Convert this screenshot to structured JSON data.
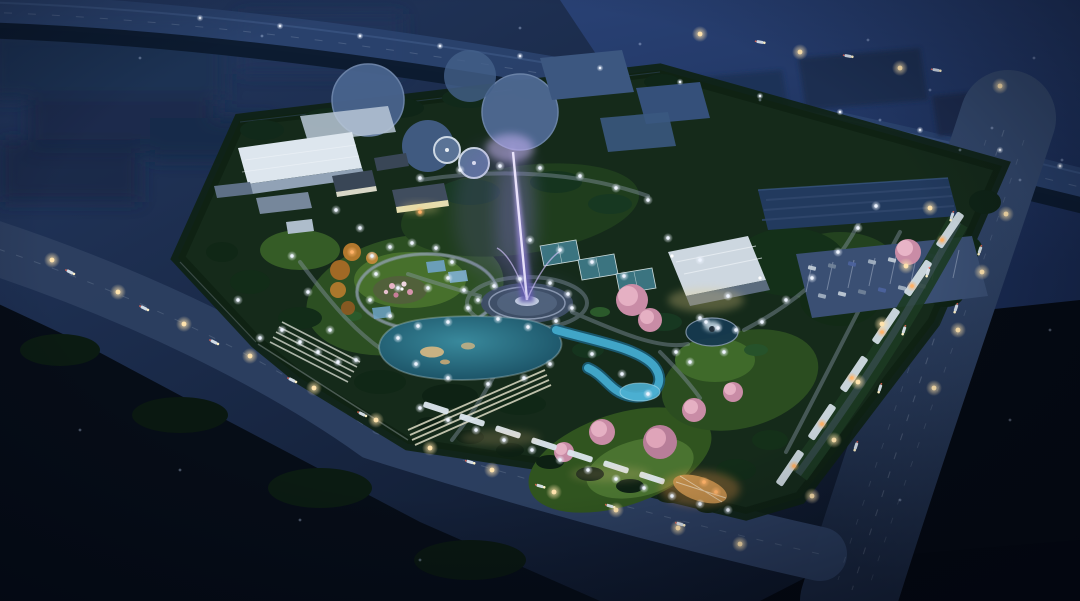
{
  "scene": {
    "type": "architectural-night-rendering",
    "subject": "Aerial night view of a landscaped park built over a water-treatment campus, surrounded by city roads",
    "time_of_day": "night",
    "features": [
      "central-plaza-with-purple-illuminated-fountain",
      "turquoise-lagoon-pond-with-islands",
      "winding-blue-stream",
      "circular-pond-with-fountain-sculpture",
      "circular-flower-garden-with-ring-path",
      "sports-courts",
      "greenhouse-gabled-building",
      "white-warehouse-buildings",
      "heritage-style-houses",
      "water-treatment-circular-tanks",
      "office-block-and-parking-lot",
      "lit-promenade-canopies-and-terraced-steps",
      "east-boulevard-with-pergolas-and-cherry-blossoms",
      "perimeter-roads-with-street-lights-and-cars",
      "highway-at-top",
      "scattered-path-lights",
      "dark-tree-masses",
      "pink-blossom-trees",
      "autumn-orange-trees",
      "hazy-city-blocks-in-distance"
    ]
  },
  "palette": {
    "bg_top": "#243962",
    "bg_bottom": "#0a1220",
    "city_haze": "#1d2f51",
    "ne_expanse_top": "#2a4378",
    "ne_expanse_bottom": "#1a2c55",
    "highway": "#2c4470",
    "treeline": "#0c1a2e",
    "forest_dark": "#060d17",
    "road": "#2c3f60",
    "road_right_top": "#33486c",
    "road_right_bottom": "#1b2942",
    "lane_mark": "#cdd9e8",
    "site_green": "#152a1a",
    "lawn": "#2c4f22",
    "lawn_lit": "#47702c",
    "pond_light": "#39899c",
    "pond_deep": "#134357",
    "stream": "#43aacb",
    "plaza": "#394a5b",
    "plaza_ring": "#9fadbf",
    "fountain_light": "#cfc0f4",
    "fountain_deep": "#5d55a8",
    "fountain_mist": "#8d7ade",
    "building_white": "#dde6ee",
    "building_face": "#91a2b6",
    "building_dim": "#b9c7d7",
    "house_roof": "#394656",
    "warm_glow": "#e9d089",
    "tank": "#49648e",
    "tank_rim": "#cdd8e4",
    "basin": "#3c5780",
    "court": "#3e7886",
    "court_line": "#d5e4e6",
    "office_block": "#223a5e",
    "parking": "#3a4f73",
    "parking_line": "#c7d2e2",
    "blossom": "#c98ca6",
    "blossom_light": "#e8b4c6",
    "autumn": "#b97b2e",
    "boulevard_bar": "#dce6ee",
    "entrance_warm": "#c9924e",
    "path": "#8b98aa",
    "path_light": "#eef4ff",
    "street_light": "#ffe3ad",
    "warm_dot": "#ffb268",
    "sparkle": "#cfe0ff",
    "car_body": "#dfe8f2",
    "headlight": "#fff2c8",
    "taillight": "#ff6a55",
    "vignette": "#020510"
  }
}
